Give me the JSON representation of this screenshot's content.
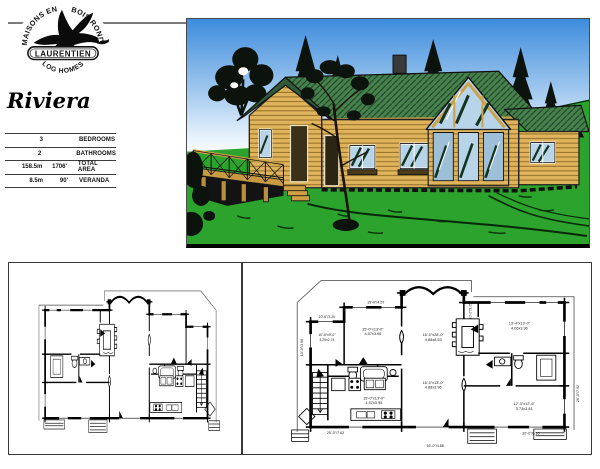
{
  "logo": {
    "arc_top_left": "MAISONS EN",
    "arc_top_right": "BOIS ROND",
    "banner": "LAURENTIEN",
    "arc_bottom": "LOG HOMES"
  },
  "title": "Riviera",
  "specs": {
    "rows": [
      {
        "metric": "3",
        "imperial": "",
        "label": "BEDROOMS"
      },
      {
        "metric": "2",
        "imperial": "",
        "label": "BATHROOMS"
      },
      {
        "metric": "158.5m",
        "imperial": "1706'",
        "label": "TOTAL AREA"
      },
      {
        "metric": "8.5m",
        "imperial": "90'",
        "label": "VERANDA"
      }
    ]
  },
  "illustration": {
    "description": "Log home exterior with green shingle roof, prow glass gable, left veranda deck, evergreen trees and lawn",
    "colors": {
      "sky": "#3d8cdd",
      "grass": "#2ca32c",
      "roof": "#47824d",
      "logs": "#dfb45c"
    }
  },
  "floor_plan": {
    "rooms": [
      {
        "imperial": "10'-6\"x9'-0\"",
        "metric": "3.20x2.74"
      },
      {
        "imperial": "15'-0\"x13'-0\"",
        "metric": "4.57x3.96"
      },
      {
        "imperial": "16'-0\"x28'-0\"",
        "metric": "4.88x8.53"
      },
      {
        "imperial": "16'-0\"x13'-0\"",
        "metric": "4.88x3.96"
      },
      {
        "imperial": "13'-4\"x13'-0\"",
        "metric": "4.06x3.96"
      },
      {
        "imperial": "15'-0\"x13'-0\"",
        "metric": "4.57x3.95"
      },
      {
        "imperial": "12'-3\"x12'-6\"",
        "metric": "3.73x3.81"
      }
    ],
    "dims": {
      "top_left": "15'-0\"/4.57",
      "left_small": "10'-6\"/3.20",
      "left_v": "13'-0\"/3.96",
      "bottom_left": "25'-0\"/7.62",
      "bottom_center": "16'-0\"/4.88",
      "bottom_right": "20'-0\"/6.10",
      "right_v": "26'-0\"/7.92",
      "prow_v": "10'-0\"/3.05"
    }
  }
}
